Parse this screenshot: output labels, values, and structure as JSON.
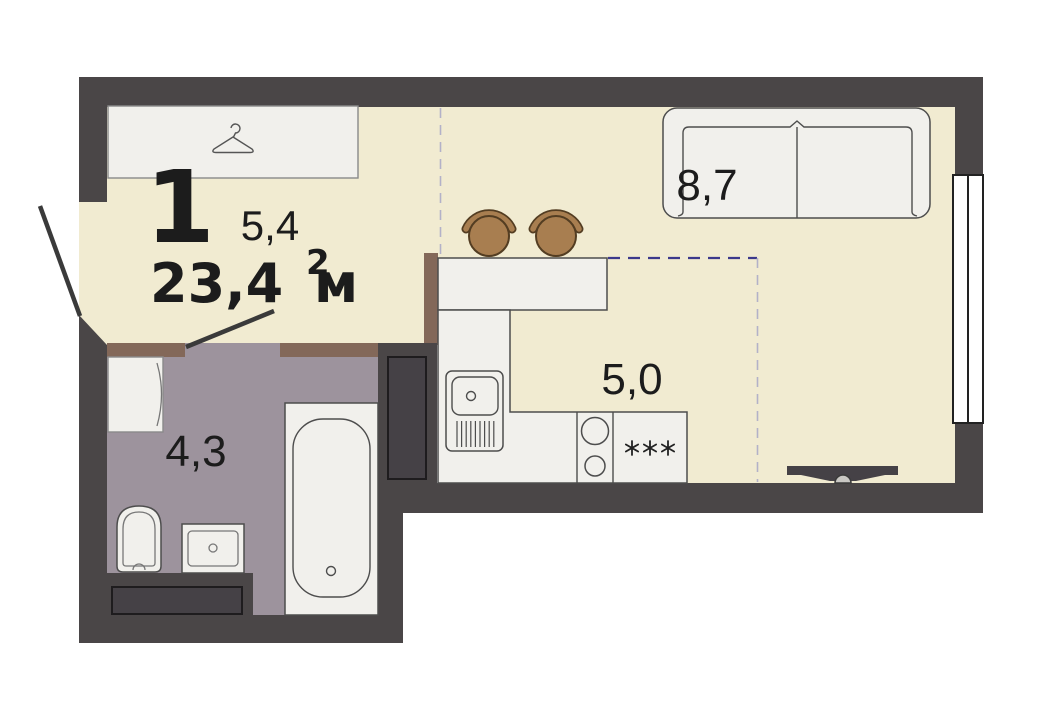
{
  "colors": {
    "bg": "#ffffff",
    "wall": "#4a4647",
    "floor": "#f1ebd1",
    "wetfloor": "#9d939d",
    "threshold": "#836859",
    "duct": "#454146",
    "furn": "#f1f0ec",
    "line": "#4d4d4d",
    "window": "#ffffff",
    "doorline": "#3a3a3a",
    "dashnavy": "#3c398b",
    "dashlight": "#b3b1c8",
    "stool": "#a87e50",
    "stooloutline": "#533d22",
    "tv": "#454146",
    "text": "#1c1c1c"
  },
  "plan": {
    "type_number": "1",
    "total_area_value": "23,4",
    "total_area_unit": "м",
    "total_area_sup": "2",
    "zones": {
      "hallway_area": "5,4",
      "living_area": "8,7",
      "kitchen_area": "5,0",
      "bathroom_area": "4,3"
    },
    "icons": {
      "hanger": "hanger-icon",
      "fridge_stars": "fridge-stars-icon"
    }
  }
}
